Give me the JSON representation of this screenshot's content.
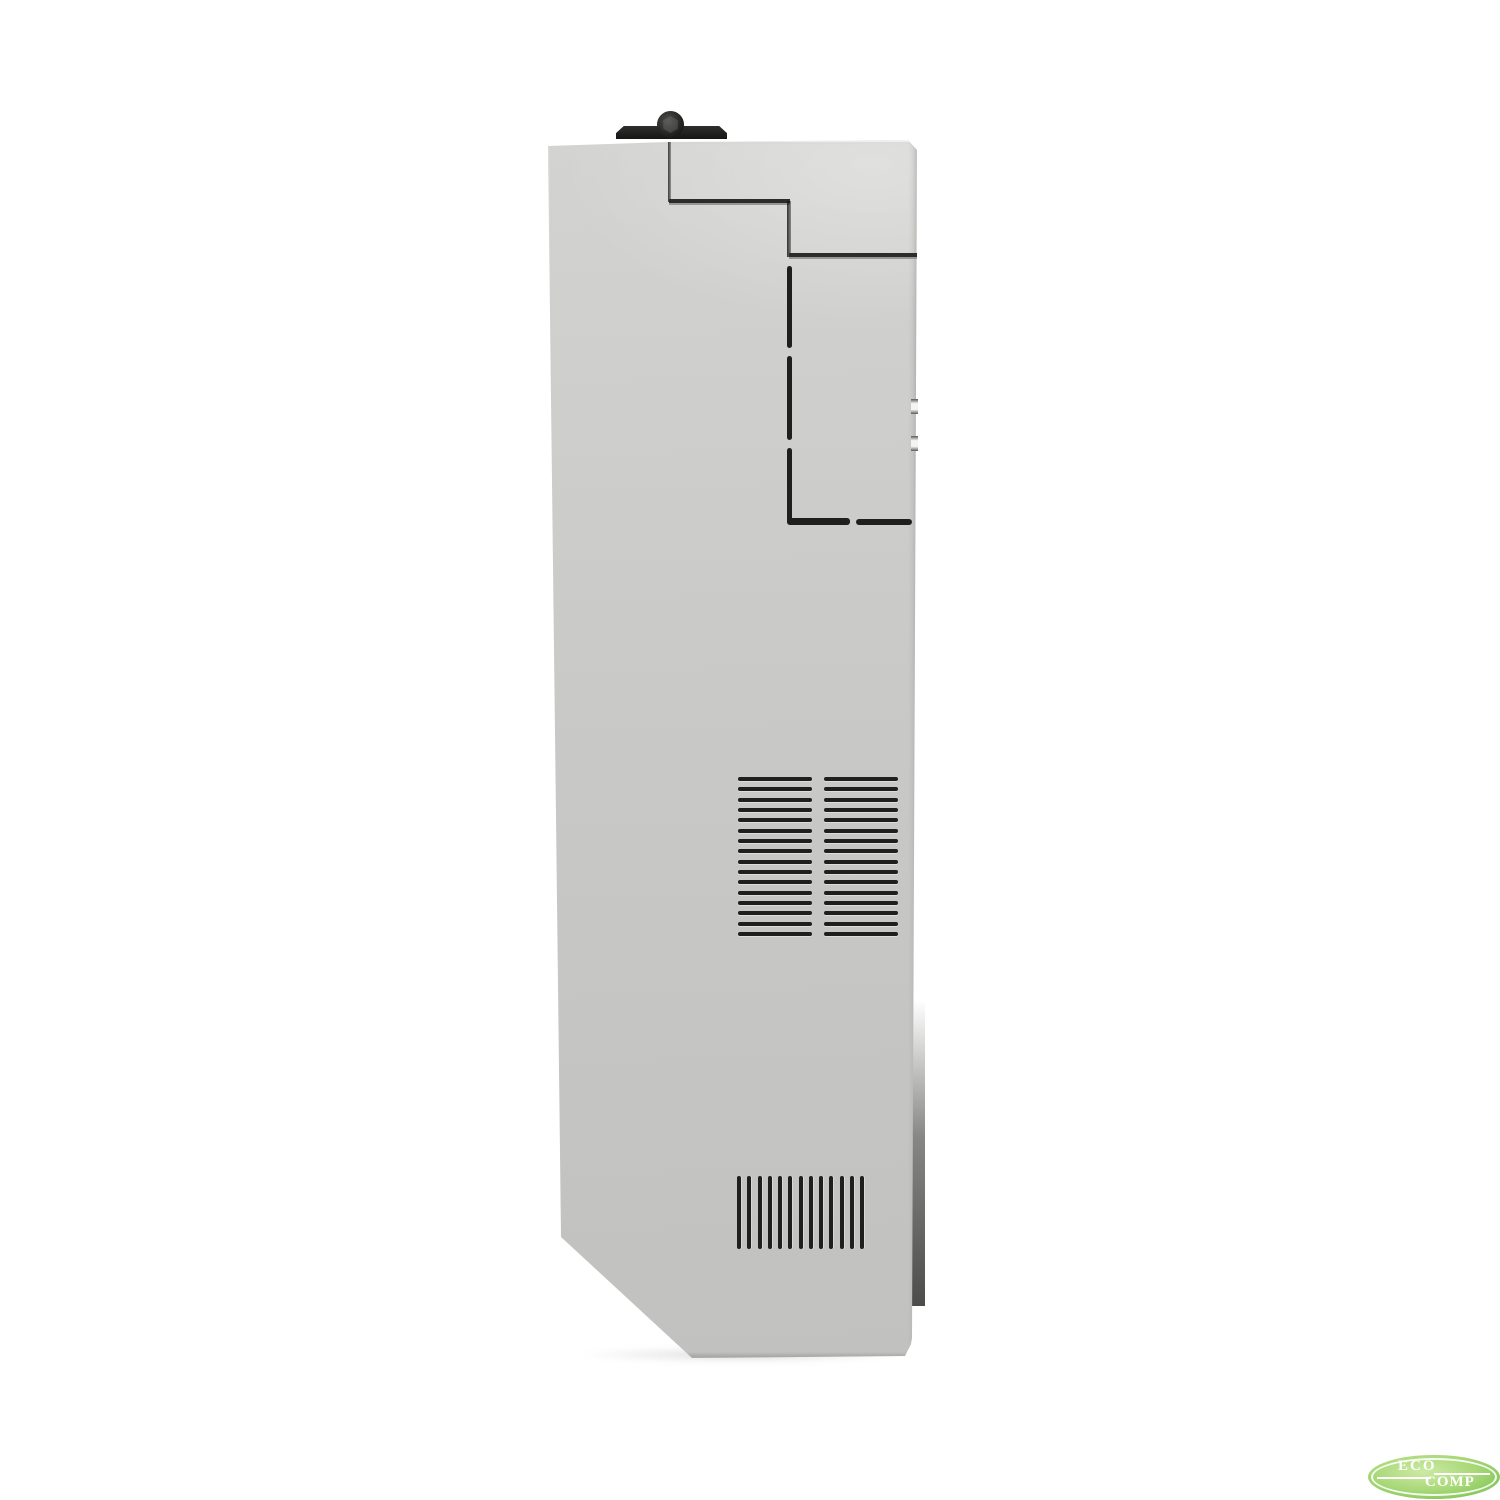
{
  "photo": {
    "background_color": "#ffffff",
    "subject": "computer-case side panel, side view product photo"
  },
  "device": {
    "colors": {
      "body_top": "#d3d3d1",
      "body_mid": "#c9c9c7",
      "body_bottom": "#c1c1bf",
      "seam": "#2c2c2a",
      "slot": "#1f1f1d",
      "latch": "#161614",
      "screw": "#4e4e4c",
      "rear_edge": "#4c4c4a"
    },
    "features": {
      "upper_vent": {
        "columns": 2,
        "slots_per_column": 16
      },
      "lower_vent": {
        "slots": 13
      },
      "slot_cutouts": 3,
      "edge_notches": 2,
      "chamfer": "bottom-left"
    }
  },
  "logo": {
    "text_top": "ECO",
    "text_bottom": "COMP",
    "colors": {
      "ellipse_outer": "#7cc454",
      "ellipse_inner": "#cdeaa4",
      "ring": "#ffffff",
      "text": "#ffffff"
    }
  }
}
